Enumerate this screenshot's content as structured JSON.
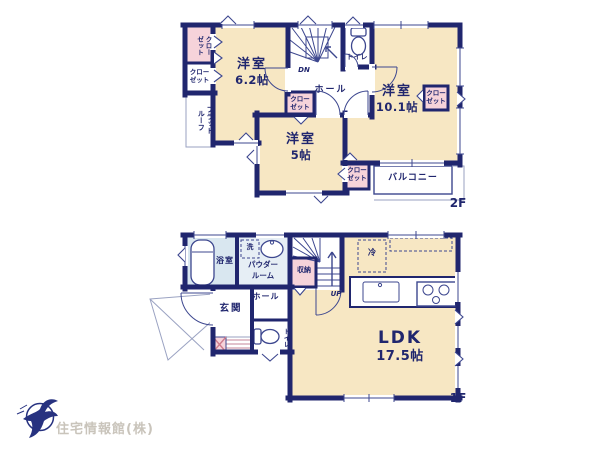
{
  "colors": {
    "wall": "#20266e",
    "ink": "#20266e",
    "room_fill": "#f7e7c3",
    "closet_fill": "#f6d3da",
    "bath_fill": "#d9e7f0",
    "powder_fill": "#e6eef5",
    "logo_text": "#c9c4bb",
    "logo_mark": "#273280"
  },
  "floor_2f": {
    "floor_label": "2F",
    "room_62": {
      "name": "洋室",
      "size": "6.2帖"
    },
    "room_5": {
      "name": "洋室",
      "size": "5帖"
    },
    "room_101": {
      "name": "洋室",
      "size": "10.1帖"
    },
    "closet_top_left": "クローゼット",
    "closet_left": "クローゼット",
    "closet_center": "クローゼット",
    "closet_bottom": "クローゼット",
    "closet_right": "クローゼット",
    "flat_roof": "フラットルーフ",
    "toilet": "トイレ",
    "hall": "ホール",
    "stairs_down": "DN",
    "balcony": "バルコニー"
  },
  "floor_1f": {
    "floor_label": "1F",
    "ldk": {
      "name": "LDK",
      "size": "17.5帖"
    },
    "bath": "浴室",
    "laundry": "洗",
    "powder_room": "パウダールーム",
    "storage": "収納",
    "stairs_up": "UP",
    "entrance": "玄関",
    "hall": "ホール",
    "toilet": "トイレ",
    "refrigerator": "冷"
  },
  "logo": {
    "company": "住宅情報館(株)"
  }
}
